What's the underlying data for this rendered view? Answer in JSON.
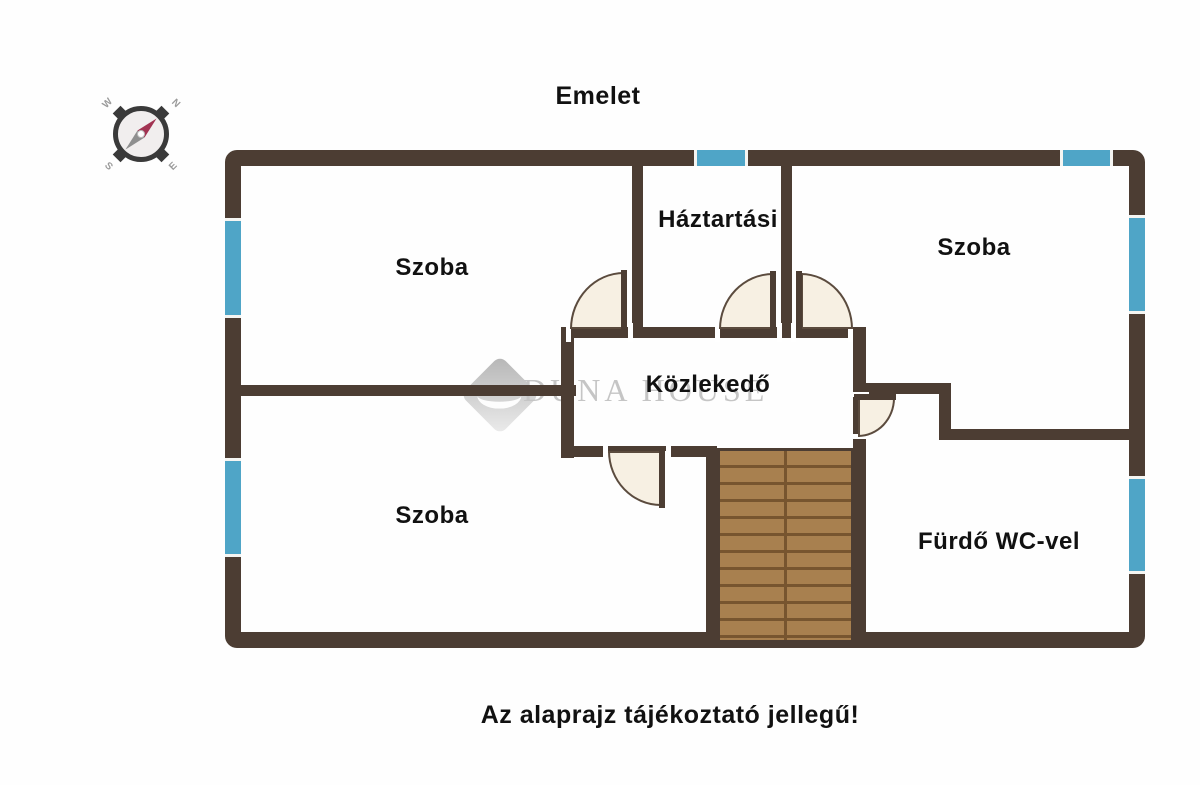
{
  "title": "Emelet",
  "footnote": "Az alaprajz tájékoztató jellegű!",
  "watermark": {
    "brand": "DUNA HOUSE"
  },
  "compass": {
    "n": "N",
    "e": "E",
    "s": "S",
    "w": "W"
  },
  "rooms": {
    "szoba_top_left": "Szoba",
    "haztartasi": "Háztartási",
    "szoba_top_right": "Szoba",
    "kozlekedo": "Közlekedő",
    "szoba_bottom_left": "Szoba",
    "furdo": "Fürdő WC-vel"
  },
  "colors": {
    "wall": "#4c3d33",
    "window": "#4fa5c7",
    "door_fill": "#f7f0e3",
    "door_line": "#5b4b3e",
    "stairs": "#a8804f",
    "stairs_line": "#77552f",
    "watermark": "#c5c5c5",
    "text": "#111111"
  }
}
